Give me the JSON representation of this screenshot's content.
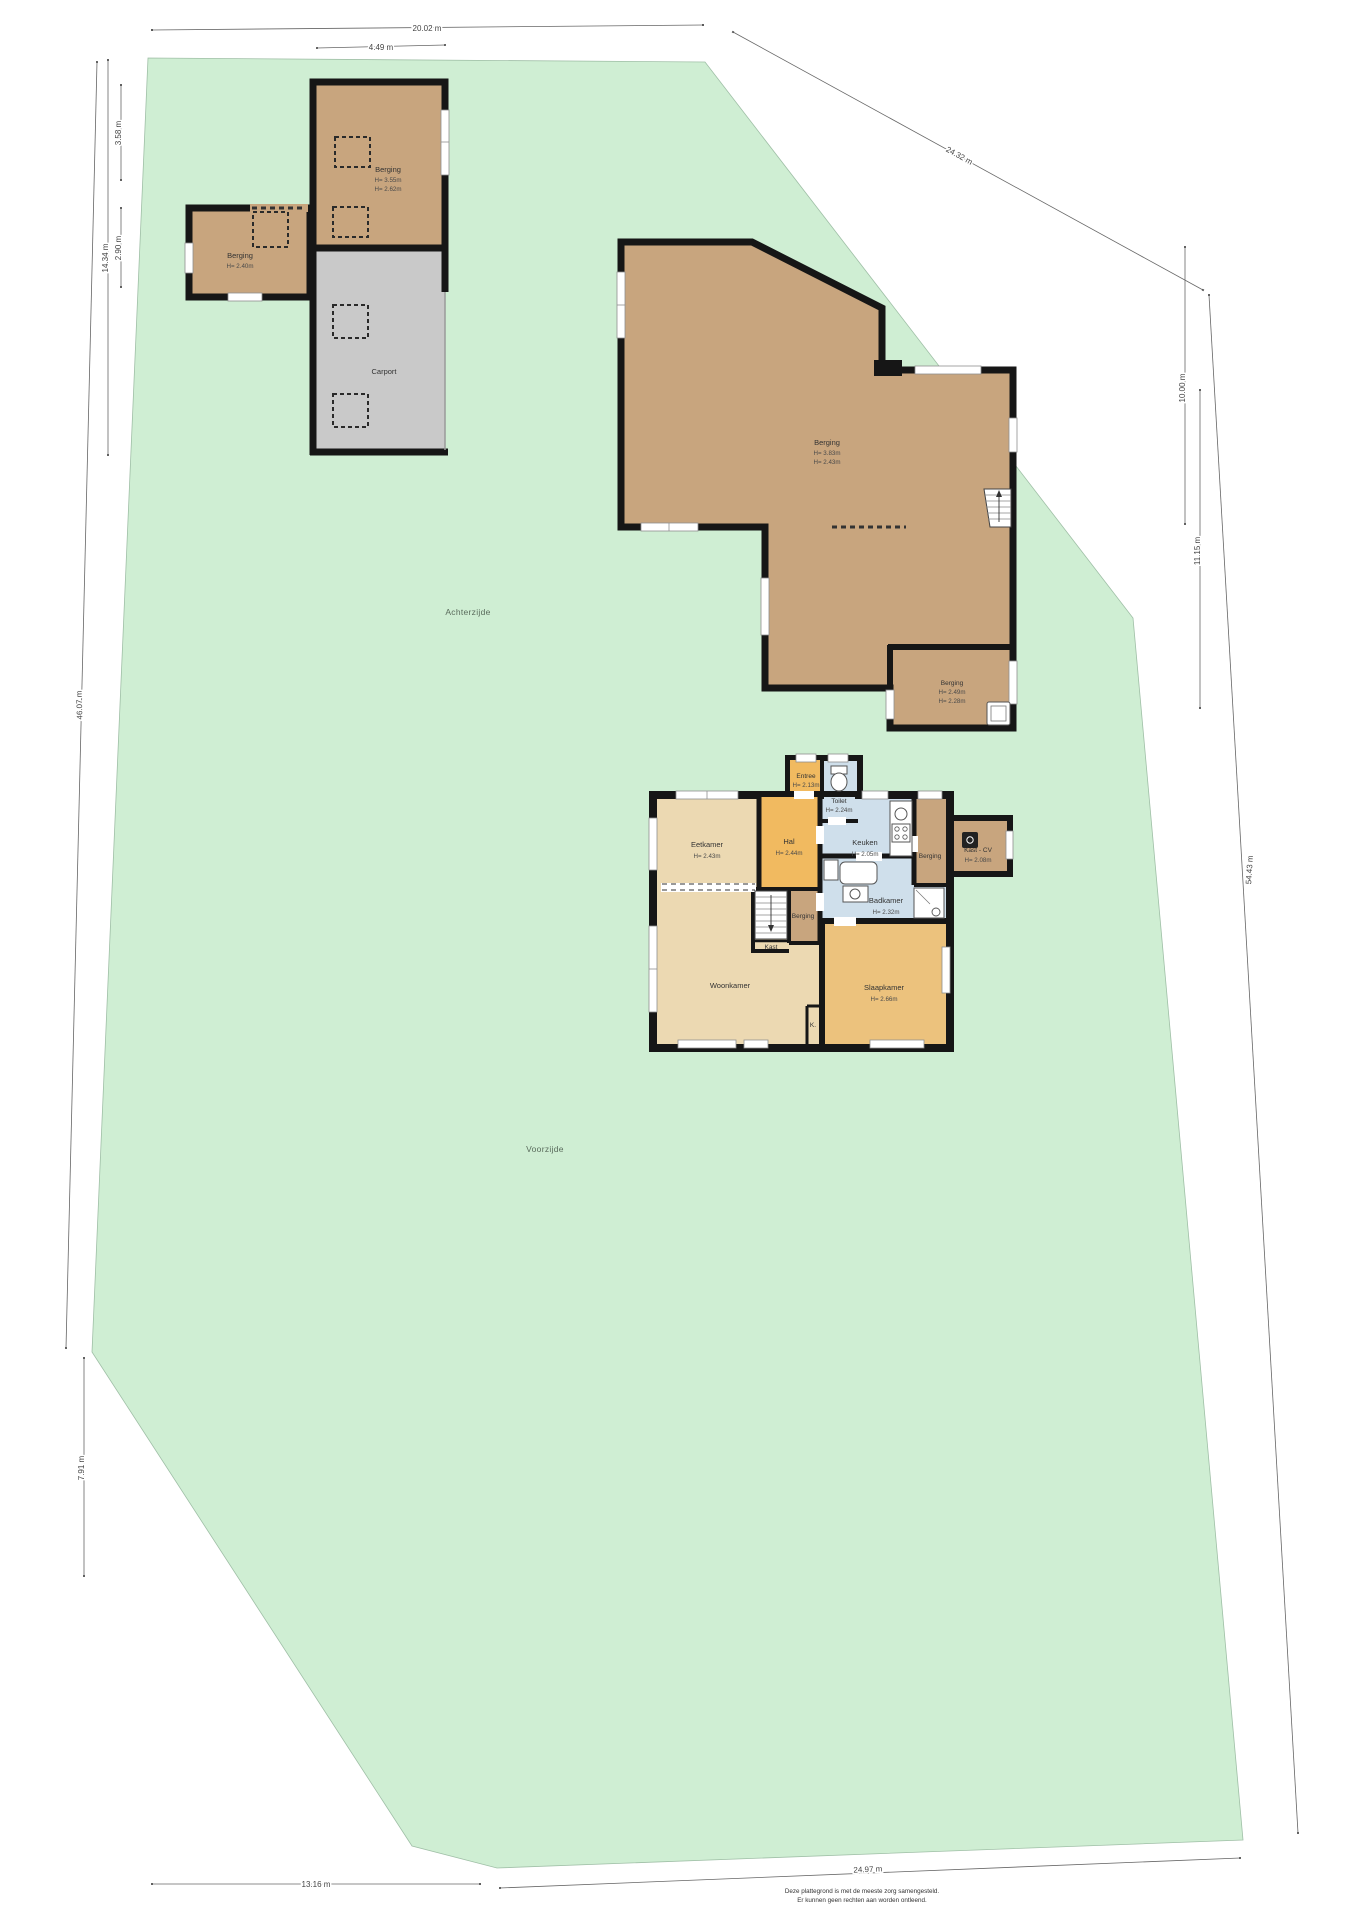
{
  "areas": {
    "back": "Achterzijde",
    "front": "Voorzijde"
  },
  "outbuildings": {
    "barn_nw": {
      "name": "Berging",
      "h1": "H= 3.55m",
      "h2": "H= 2.62m"
    },
    "shed_w": {
      "name": "Berging",
      "h1": "H= 2.40m"
    },
    "carport": {
      "name": "Carport"
    },
    "barn_ne": {
      "name": "Berging",
      "h1": "H= 3.83m",
      "h2": "H= 2.43m"
    },
    "barn_ne_annex": {
      "name": "Berging",
      "h1": "H= 2.49m",
      "h2": "H= 2.28m"
    }
  },
  "rooms": {
    "entree": {
      "name": "Entree",
      "h": "H= 2.13m"
    },
    "toilet": {
      "name": "Toilet",
      "h": "H= 2.24m"
    },
    "hal": {
      "name": "Hal",
      "h": "H= 2.44m"
    },
    "eetkamer": {
      "name": "Eetkamer",
      "h": "H= 2.43m"
    },
    "keuken": {
      "name": "Keuken",
      "h": "H= 2.05m"
    },
    "berging_rechts": {
      "name": "Berging"
    },
    "kast_cv": {
      "name": "Kast - CV",
      "h": "H= 2.08m"
    },
    "badkamer": {
      "name": "Badkamer",
      "h": "H= 2.32m"
    },
    "berging_midden": {
      "name": "Berging"
    },
    "kast": {
      "name": "Kast"
    },
    "woonkamer": {
      "name": "Woonkamer"
    },
    "slaapkamer": {
      "name": "Slaapkamer",
      "h": "H= 2.66m"
    },
    "k": {
      "name": "K."
    }
  },
  "dimensions": {
    "top_main": "20.02 m",
    "top_barn": "4.49 m",
    "ne_diagonal": "24.32 m",
    "right_upper": "10.00 m",
    "right_mid": "11.15 m",
    "right_long": "54.43 m",
    "left_upper": "3.58 m",
    "left_mid": "2.90 m",
    "left_outer": "14.34 m",
    "left_long": "46.07 m",
    "left_lower": "7.91 m",
    "bottom_left": "13.16 m",
    "bottom_right": "24.97 m"
  },
  "disclaimer": {
    "line1": "Deze plattegrond is met de meeste zorg samengesteld.",
    "line2": "Er kunnen geen rechten aan worden ontleend."
  },
  "colors": {
    "plot_green": "#cfeed3",
    "barn_brown": "#c8a57e",
    "carport_gray": "#c9c9c9",
    "room_tan": "#ecd9b2",
    "room_orange": "#f1ba60",
    "room_orange_muted": "#ecc27d",
    "room_blue": "#cfdfeb",
    "wall_black": "#161616"
  }
}
